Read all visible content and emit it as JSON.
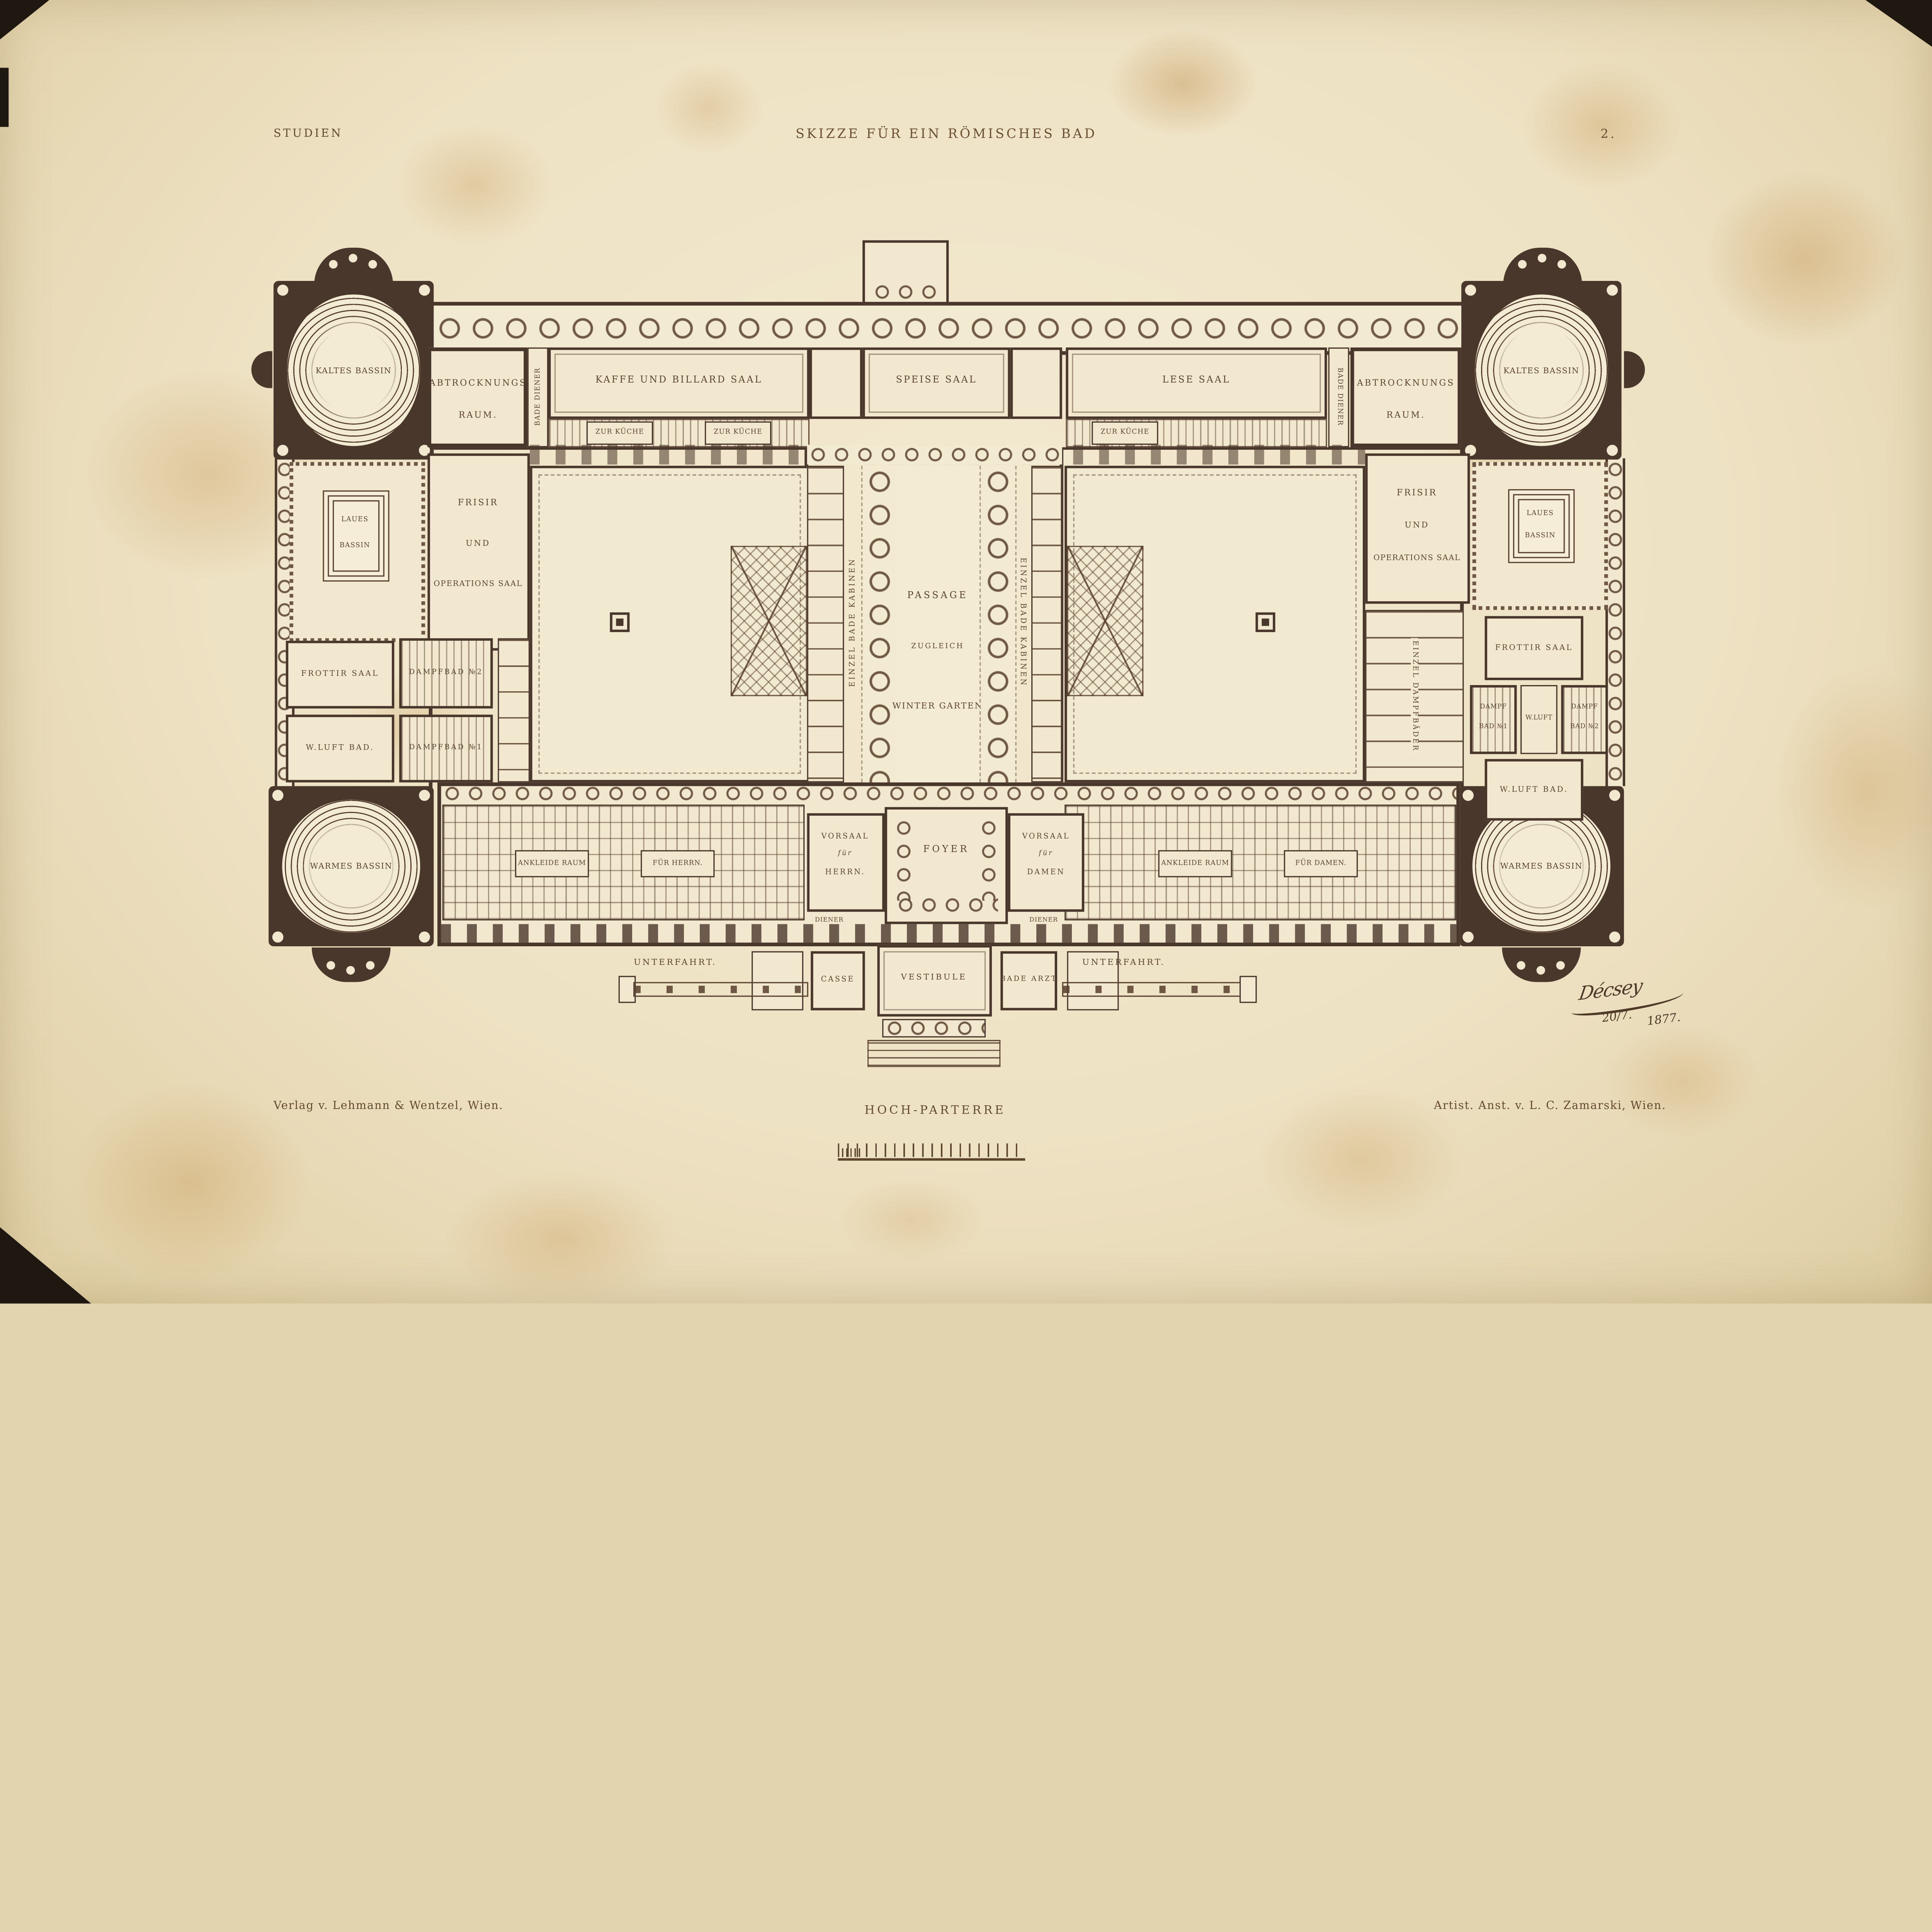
{
  "page": {
    "series_label": "STUDIEN",
    "title": "SKIZZE FÜR EIN RÖMISCHES BAD",
    "plate_number": "2.",
    "floor_caption": "HOCH-PARTERRE",
    "publisher_caption": "Verlag v. Lehmann & Wentzel, Wien.",
    "printer_caption": "Artist. Anst. v. L. C. Zamarski, Wien.",
    "signature_name": "Décsey",
    "signature_date_1": "20/7.",
    "signature_date_2": "1877."
  },
  "plan": {
    "kaltes_bassin": "KALTES BASSIN",
    "warmes_bassin": "WARMES BASSIN",
    "abtrocknungs_1": "ABTROCKNUNGS",
    "abtrocknungs_2": "RAUM.",
    "bade_diener": "BADE DIENER",
    "kaffe_billard_saal": "KAFFE UND BILLARD SAAL",
    "speise_saal": "SPEISE SAAL",
    "lese_saal": "LESE SAAL",
    "zur_kueche": "ZUR KÜCHE",
    "laues_1": "LAUES",
    "laues_2": "BASSIN",
    "frisir_1": "FRISIR",
    "frisir_2": "UND",
    "frisir_3": "OPERATIONS SAAL",
    "passage_1": "PASSAGE",
    "passage_2": "ZUGLEICH",
    "passage_3": "WINTER GARTEN",
    "einzel_bade_kabinen": "EINZEL BADE KABINEN",
    "einzel_dampfbaeder": "EINZEL DAMPFBÄDER",
    "frottir_saal": "FROTTIR SAAL",
    "dampfbad_no2": "DAMPFBAD №2",
    "dampfbad_no1": "DAMPFBAD №1",
    "w_luft_bad": "W.LUFT BAD.",
    "dampf": "DAMPF",
    "bad_no1": "BAD №1",
    "bad_no2": "BAD №2",
    "w_luft": "W.LUFT",
    "ankleide_raum": "ANKLEIDE RAUM",
    "fuer_herrn": "FÜR HERRN.",
    "fuer_damen": "FÜR DAMEN.",
    "vorsaal": "VORSAAL",
    "fuer": "für",
    "herrn": "HERRN.",
    "damen": "DAMEN",
    "foyer": "FOYER",
    "diener": "DIENER",
    "casse": "CASSE",
    "vestibule": "VESTIBULE",
    "bade_arzt": "BADE ARZT",
    "unterfahrt": "UNTERFAHRT."
  },
  "colors": {
    "paper": "#f2e8d0",
    "ink": "#5a4331",
    "poche": "#4a372b",
    "stain": "#c89a55"
  }
}
